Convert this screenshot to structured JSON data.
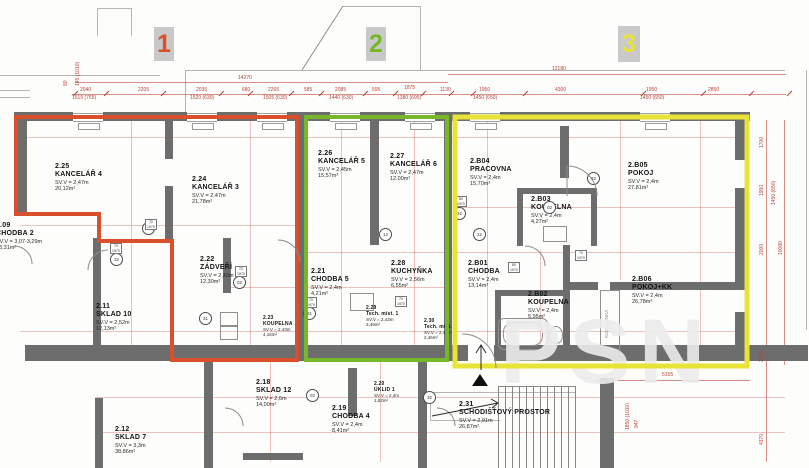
{
  "zones": [
    {
      "number": "1",
      "color": "#d9502c"
    },
    {
      "number": "2",
      "color": "#76b82a"
    },
    {
      "number": "3",
      "color": "#e8e337"
    }
  ],
  "rooms": [
    {
      "id": "2.09",
      "name": "CHODBA 2",
      "height": "SV.V = 3,07-3,29m",
      "area": "23,31m²"
    },
    {
      "id": "2.25",
      "name": "KANCELÁŘ 4",
      "height": "SV.V = 2,47m",
      "area": "20,12m²"
    },
    {
      "id": "2.24",
      "name": "KANCELÁŘ 3",
      "height": "SV.V = 2,47m",
      "area": "21,78m²"
    },
    {
      "id": "2.26",
      "name": "KANCELÁŘ 5",
      "height": "SV.V = 2,45m",
      "area": "15,57m²"
    },
    {
      "id": "2.27",
      "name": "KANCELÁŘ 6",
      "height": "SV.V = 2,47m",
      "area": "12,00m²"
    },
    {
      "id": "2.B04",
      "name": "PRACOVNA",
      "height": "SV.V = 2,4m",
      "area": "15,70m²"
    },
    {
      "id": "2.B05",
      "name": "POKOJ",
      "height": "SV.V = 2,4m",
      "area": "27,81m²"
    },
    {
      "id": "2.B03",
      "name": "KOUPELNA",
      "height": "SV.V = 2,4m",
      "area": "4,27m²"
    },
    {
      "id": "2.11",
      "name": "SKLAD 10",
      "height": "SV.V = 2,52m",
      "area": "12,13m²"
    },
    {
      "id": "2.22",
      "name": "ZÁDVEŘÍ",
      "height": "SV.V = 2,43m",
      "area": "12,30m²"
    },
    {
      "id": "2.21",
      "name": "CHODBA 5",
      "height": "SV.V = 2,4m",
      "area": "4,21m²"
    },
    {
      "id": "2.28",
      "name": "KUCHYŇKA",
      "height": "SV.V = 2,56m",
      "area": "6,55m²"
    },
    {
      "id": "2.23",
      "name": "KOUPELNA",
      "height": "SV.V = 2,43m",
      "area": "4,16m²"
    },
    {
      "id": "2.29",
      "name": "Tech. míst. 1",
      "height": "SV.V = 2,43m",
      "area": "3,46m²"
    },
    {
      "id": "2.30",
      "name": "Tech. míst.",
      "height": "SV.V = 2,43m",
      "area": "2,46m²"
    },
    {
      "id": "2.B01",
      "name": "CHODBA",
      "height": "SV.V = 2,4m",
      "area": "13,14m²"
    },
    {
      "id": "2.B02",
      "name": "KOUPELNA",
      "height": "SV.V = 2,4m",
      "area": "5,95m²"
    },
    {
      "id": "2.B06",
      "name": "POKOJ+KK",
      "height": "SV.V = 2,4m",
      "area": "26,78m²"
    },
    {
      "id": "2.18",
      "name": "SKLAD 12",
      "height": "SV.V = 2,6m",
      "area": "14,00m²"
    },
    {
      "id": "2.19",
      "name": "CHODBA 4",
      "height": "SV.V = 2,4m",
      "area": "8,41m²"
    },
    {
      "id": "2.20",
      "name": "ÚKLID 1",
      "height": "SV.V = 2,4m",
      "area": "1,52m²"
    },
    {
      "id": "2.12",
      "name": "SKLAD 7",
      "height": "SV.V = 3,3m",
      "area": "38,86m²"
    },
    {
      "id": "2.31",
      "name": "SCHODIŠŤOVÝ PROSTOR",
      "height": "SV.V = 2,91m",
      "area": "26,87m²"
    }
  ],
  "dims": {
    "total_left": "14270",
    "total_right": "12180",
    "row": [
      "2040",
      "2205",
      "2035",
      "680",
      "2265",
      "585",
      "2085",
      "595",
      "1875",
      "1130",
      "1950",
      "4300",
      "1950",
      "2850"
    ],
    "sub": [
      "1515 (765)",
      "1520 (630)",
      "1505 (630)",
      "1440 (630)",
      "1380 (695)",
      "1450 (650)",
      "1450 (650)"
    ],
    "left": [
      "80",
      "145 (1010)"
    ],
    "right": [
      "1700",
      "1950",
      "1450 (650)",
      "2000",
      "10080",
      "2080",
      "5155",
      "4370",
      "1850 (1010)",
      "947"
    ]
  },
  "refs": [
    "31",
    "32",
    "02",
    "31",
    "31",
    "12",
    "32",
    "02",
    "32",
    "22",
    "02",
    "32"
  ],
  "tags": [
    {
      "w": "70",
      "h": "1970"
    },
    {
      "w": "80",
      "h": "1970"
    },
    {
      "w": "70",
      "h": "1970"
    },
    {
      "w": "70",
      "h": "1970"
    },
    {
      "w": "70",
      "h": "1970"
    },
    {
      "w": "70",
      "h": "1970"
    },
    {
      "w": "80",
      "h": "1970"
    },
    {
      "w": "70",
      "h": "1970"
    }
  ],
  "labels": {
    "kuch_linka": "KUCH. LINKA"
  },
  "watermark": "PSN"
}
